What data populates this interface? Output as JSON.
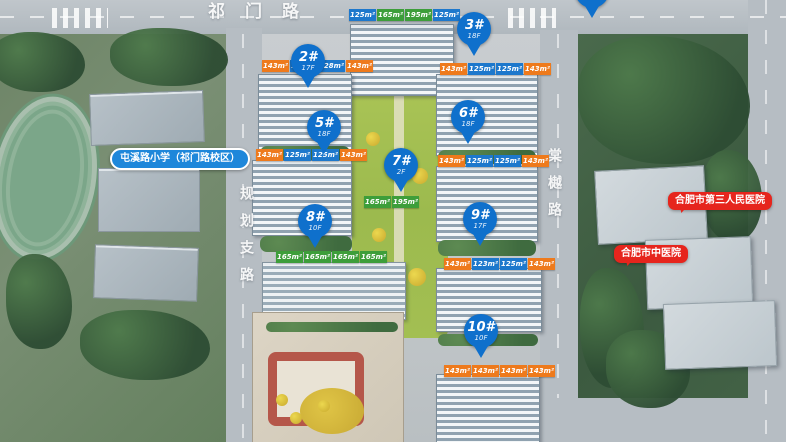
{
  "roads": {
    "top": "祁门路",
    "left": "规划支路",
    "right": "棠樾路"
  },
  "pois": {
    "school": "屯溪路小学（祁门路校区）",
    "hospital_1": "合肥市第三人民医院",
    "hospital_2": "合肥市中医院"
  },
  "colors": {
    "pin": "#0f70cc",
    "school": "#1e87da",
    "hospital": "#e6251d",
    "orange": "#ee7a1c",
    "blue": "#1d78cc",
    "green": "#3d9e3a"
  },
  "buildings": [
    {
      "id": "top",
      "units": [
        {
          "v": "125m²",
          "c": "#1d78cc"
        },
        {
          "v": "165m²",
          "c": "#3d9e3a"
        },
        {
          "v": "195m²",
          "c": "#3d9e3a"
        },
        {
          "v": "125m²",
          "c": "#1d78cc"
        }
      ]
    },
    {
      "id": "2",
      "pin": "2#",
      "floors": "17F",
      "units": [
        {
          "v": "143m²",
          "c": "#ee7a1c"
        },
        {
          "v": "123m²",
          "c": "#1d78cc"
        },
        {
          "v": "128m²",
          "c": "#1d78cc"
        },
        {
          "v": "143m²",
          "c": "#ee7a1c"
        }
      ]
    },
    {
      "id": "3",
      "pin": "3#",
      "floors": "18F",
      "units": [
        {
          "v": "143m²",
          "c": "#ee7a1c"
        },
        {
          "v": "125m²",
          "c": "#1d78cc"
        },
        {
          "v": "125m²",
          "c": "#1d78cc"
        },
        {
          "v": "143m²",
          "c": "#ee7a1c"
        }
      ]
    },
    {
      "id": "5",
      "pin": "5#",
      "floors": "18F",
      "units": [
        {
          "v": "143m²",
          "c": "#ee7a1c"
        },
        {
          "v": "125m²",
          "c": "#1d78cc"
        },
        {
          "v": "125m²",
          "c": "#1d78cc"
        },
        {
          "v": "143m²",
          "c": "#ee7a1c"
        }
      ]
    },
    {
      "id": "6",
      "pin": "6#",
      "floors": "18F",
      "units": [
        {
          "v": "143m²",
          "c": "#ee7a1c"
        },
        {
          "v": "125m²",
          "c": "#1d78cc"
        },
        {
          "v": "125m²",
          "c": "#1d78cc"
        },
        {
          "v": "143m²",
          "c": "#ee7a1c"
        }
      ]
    },
    {
      "id": "7",
      "pin": "7#",
      "floors": "2F",
      "units": [
        {
          "v": "165m²",
          "c": "#3d9e3a"
        },
        {
          "v": "195m²",
          "c": "#3d9e3a"
        }
      ]
    },
    {
      "id": "8",
      "pin": "8#",
      "floors": "10F",
      "units": [
        {
          "v": "165m²",
          "c": "#3d9e3a"
        },
        {
          "v": "165m²",
          "c": "#3d9e3a"
        },
        {
          "v": "165m²",
          "c": "#3d9e3a"
        },
        {
          "v": "165m²",
          "c": "#3d9e3a"
        }
      ]
    },
    {
      "id": "9",
      "pin": "9#",
      "floors": "17F",
      "units": [
        {
          "v": "143m²",
          "c": "#ee7a1c"
        },
        {
          "v": "123m²",
          "c": "#1d78cc"
        },
        {
          "v": "125m²",
          "c": "#1d78cc"
        },
        {
          "v": "143m²",
          "c": "#ee7a1c"
        }
      ]
    },
    {
      "id": "10",
      "pin": "10#",
      "floors": "10F",
      "units": [
        {
          "v": "143m²",
          "c": "#ee7a1c"
        },
        {
          "v": "143m²",
          "c": "#ee7a1c"
        },
        {
          "v": "143m²",
          "c": "#ee7a1c"
        },
        {
          "v": "143m²",
          "c": "#ee7a1c"
        }
      ]
    }
  ]
}
